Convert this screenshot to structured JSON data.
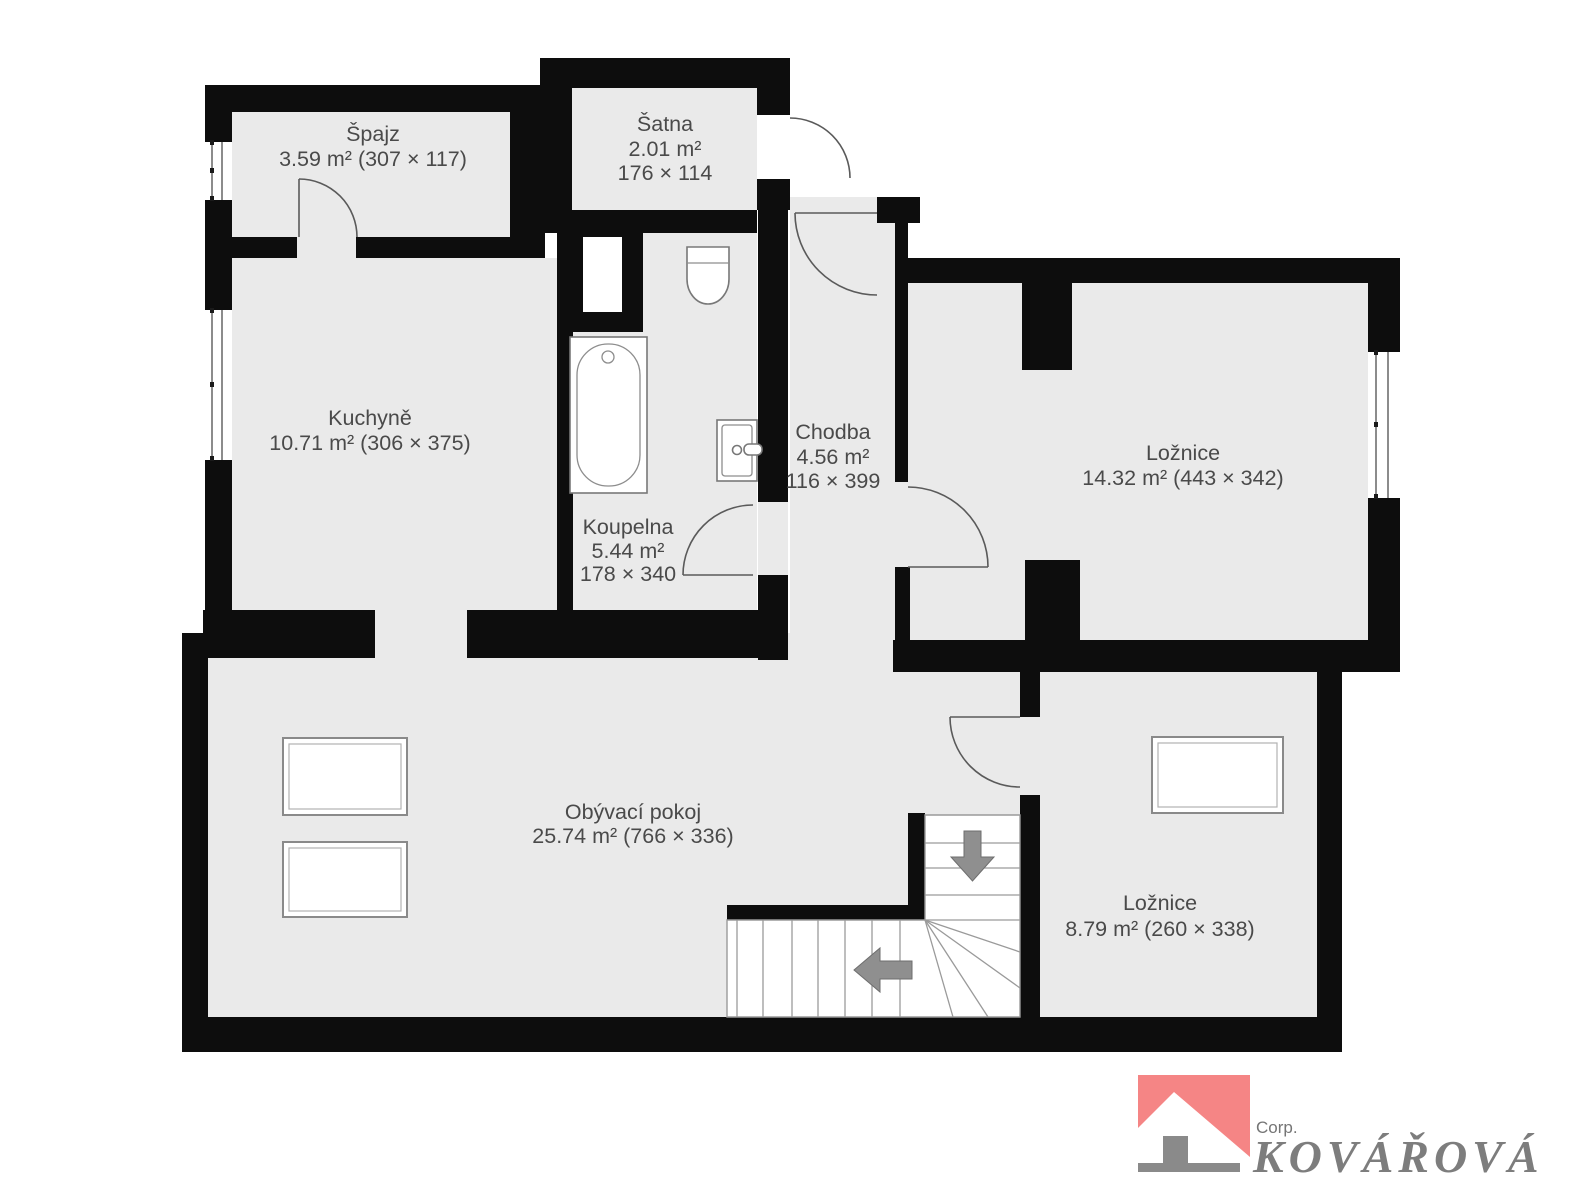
{
  "plan_title": "Floor plan",
  "colors": {
    "wall": "#0d0d0d",
    "floor": "#eaeaea",
    "label_text": "#4a4a4a",
    "logo_accent": "#f58585",
    "logo_gray": "#8a8a8a",
    "logo_text": "#7d7d7d"
  },
  "rooms": {
    "spajz": {
      "name": "Špajz",
      "line2": "3.59 m² (307 × 117)"
    },
    "satna": {
      "name": "Šatna",
      "line2": "2.01 m²",
      "line3": "176 × 114"
    },
    "kuchyne": {
      "name": "Kuchyně",
      "line2": "10.71 m² (306 × 375)"
    },
    "koupelna": {
      "name": "Koupelna",
      "line2": "5.44 m²",
      "line3": "178 × 340"
    },
    "chodba": {
      "name": "Chodba",
      "line2": "4.56 m²",
      "line3": "116 × 399"
    },
    "loznice_top": {
      "name": "Ložnice",
      "line2": "14.32 m² (443 × 342)"
    },
    "obyvaci_pokoj": {
      "name": "Obývací pokoj",
      "line2": "25.74 m² (766 × 336)"
    },
    "loznice_bottom": {
      "name": "Ložnice",
      "line2": "8.79 m² (260 × 338)"
    }
  },
  "logo": {
    "corp_label": "Corp.",
    "company_name": "KOVÁŘOVÁ",
    "accent_color": "#f58585"
  }
}
